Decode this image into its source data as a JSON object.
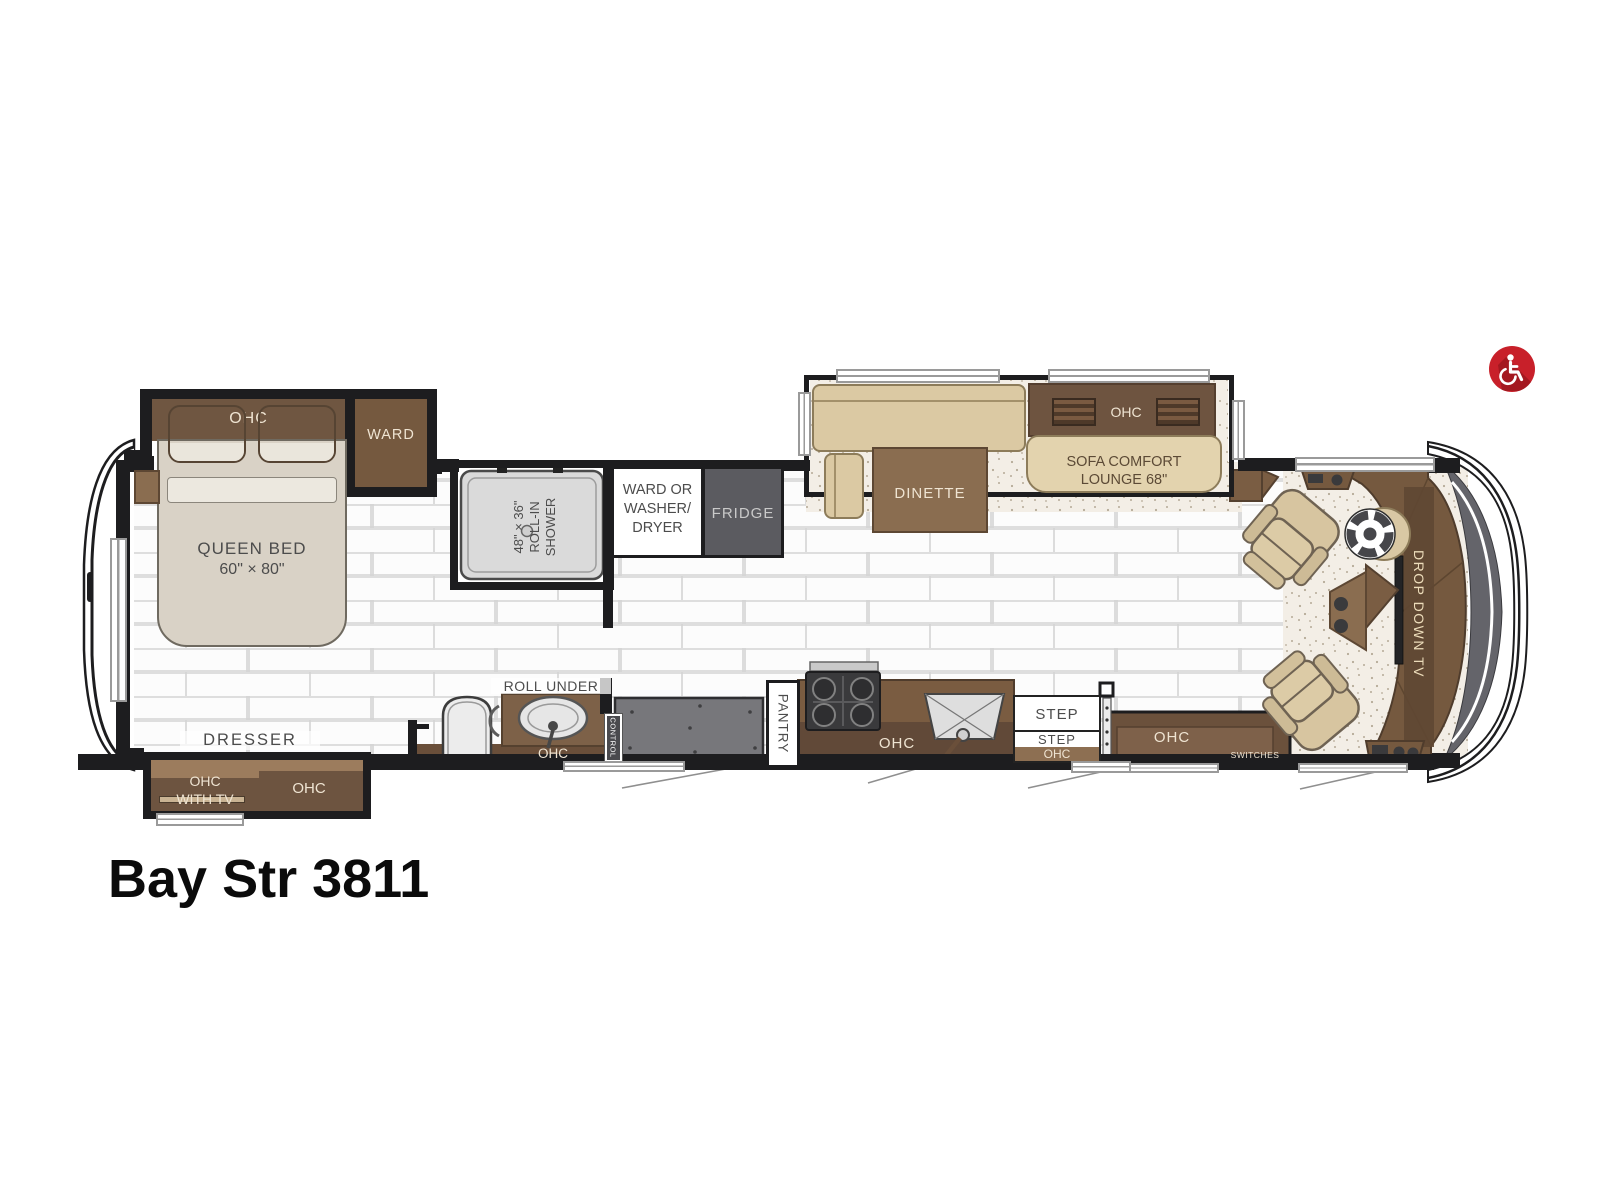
{
  "title": "Bay Str 3811",
  "icons": {
    "accessibility": "wheelchair-icon"
  },
  "colors": {
    "accent_red": "#c8202a",
    "cabinet_brown": "#6e5540",
    "wall_black": "#1d1d1f"
  },
  "bedroom": {
    "ohc": "OHC",
    "ward": "WARD",
    "bed_line1": "QUEEN BED",
    "bed_line2": "60\" × 80\"",
    "dresser": "DRESSER",
    "slide_ohc_tv_line1": "OHC",
    "slide_ohc_tv_line2": "WITH TV",
    "slide_ohc": "OHC"
  },
  "bath": {
    "shower_line1": "48\" × 36\"",
    "shower_line2": "ROLL-IN SHOWER",
    "roll_under": "ROLL UNDER",
    "vanity_ohc": "OHC",
    "control": "CONTROL",
    "ward_washer_line1": "WARD OR",
    "ward_washer_line2": "WASHER/",
    "ward_washer_line3": "DRYER",
    "fridge": "FRIDGE",
    "pantry": "PANTRY"
  },
  "kitchen": {
    "ohc": "OHC",
    "step_upper": "STEP",
    "step_lower": "STEP",
    "step_ohc": "OHC"
  },
  "living": {
    "dinette": "DINETTE",
    "sofa_ohc": "OHC",
    "sofa_line1": "SOFA COMFORT",
    "sofa_line2": "LOUNGE 68\"",
    "entry_ohc": "OHC",
    "switches": "SWITCHES"
  },
  "cockpit": {
    "drop_down_tv": "DROP DOWN TV"
  }
}
